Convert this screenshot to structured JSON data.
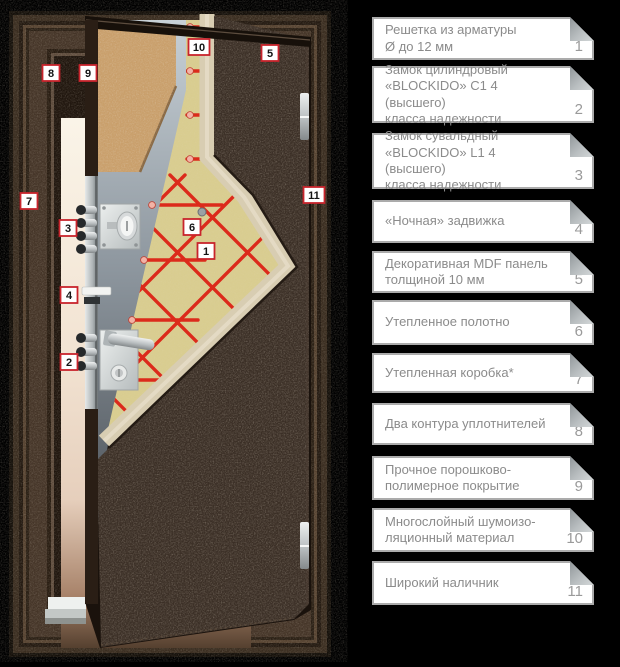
{
  "legend": {
    "items": [
      {
        "number": "1",
        "label": "Решетка из арматуры\nØ до 12 мм"
      },
      {
        "number": "2",
        "label": "Замок цилиндровый\n«BLOCKIDO» C1 4 (высшего)\nкласса надежности"
      },
      {
        "number": "3",
        "label": "Замок сувальдный\n«BLOCKIDO» L1 4 (высшего)\nкласса надежности"
      },
      {
        "number": "4",
        "label": "«Ночная» задвижка"
      },
      {
        "number": "5",
        "label": "Декоративная MDF панель\nтолщиной 10 мм"
      },
      {
        "number": "6",
        "label": "Утепленное полотно"
      },
      {
        "number": "7",
        "label": "Утепленная коробка*"
      },
      {
        "number": "8",
        "label": "Два контура уплотнителей"
      },
      {
        "number": "9",
        "label": "Прочное порошково-\nполимерное покрытие"
      },
      {
        "number": "10",
        "label": "Многослойный шумоизо-\nляционный материал"
      },
      {
        "number": "11",
        "label": "Широкий наличник"
      }
    ]
  },
  "door": {
    "markers": [
      "1",
      "2",
      "3",
      "4",
      "5",
      "6",
      "7",
      "8",
      "9",
      "10",
      "11"
    ]
  },
  "colors": {
    "background": "#000000",
    "marker_border": "#c8242c",
    "rebar_grid_red": "#dc2a1b",
    "legend_border": "#ababab",
    "legend_text": "#8b8b8b",
    "door_panel_brown": "#3b2f26",
    "insulation_yellow": "#d9cd90"
  }
}
